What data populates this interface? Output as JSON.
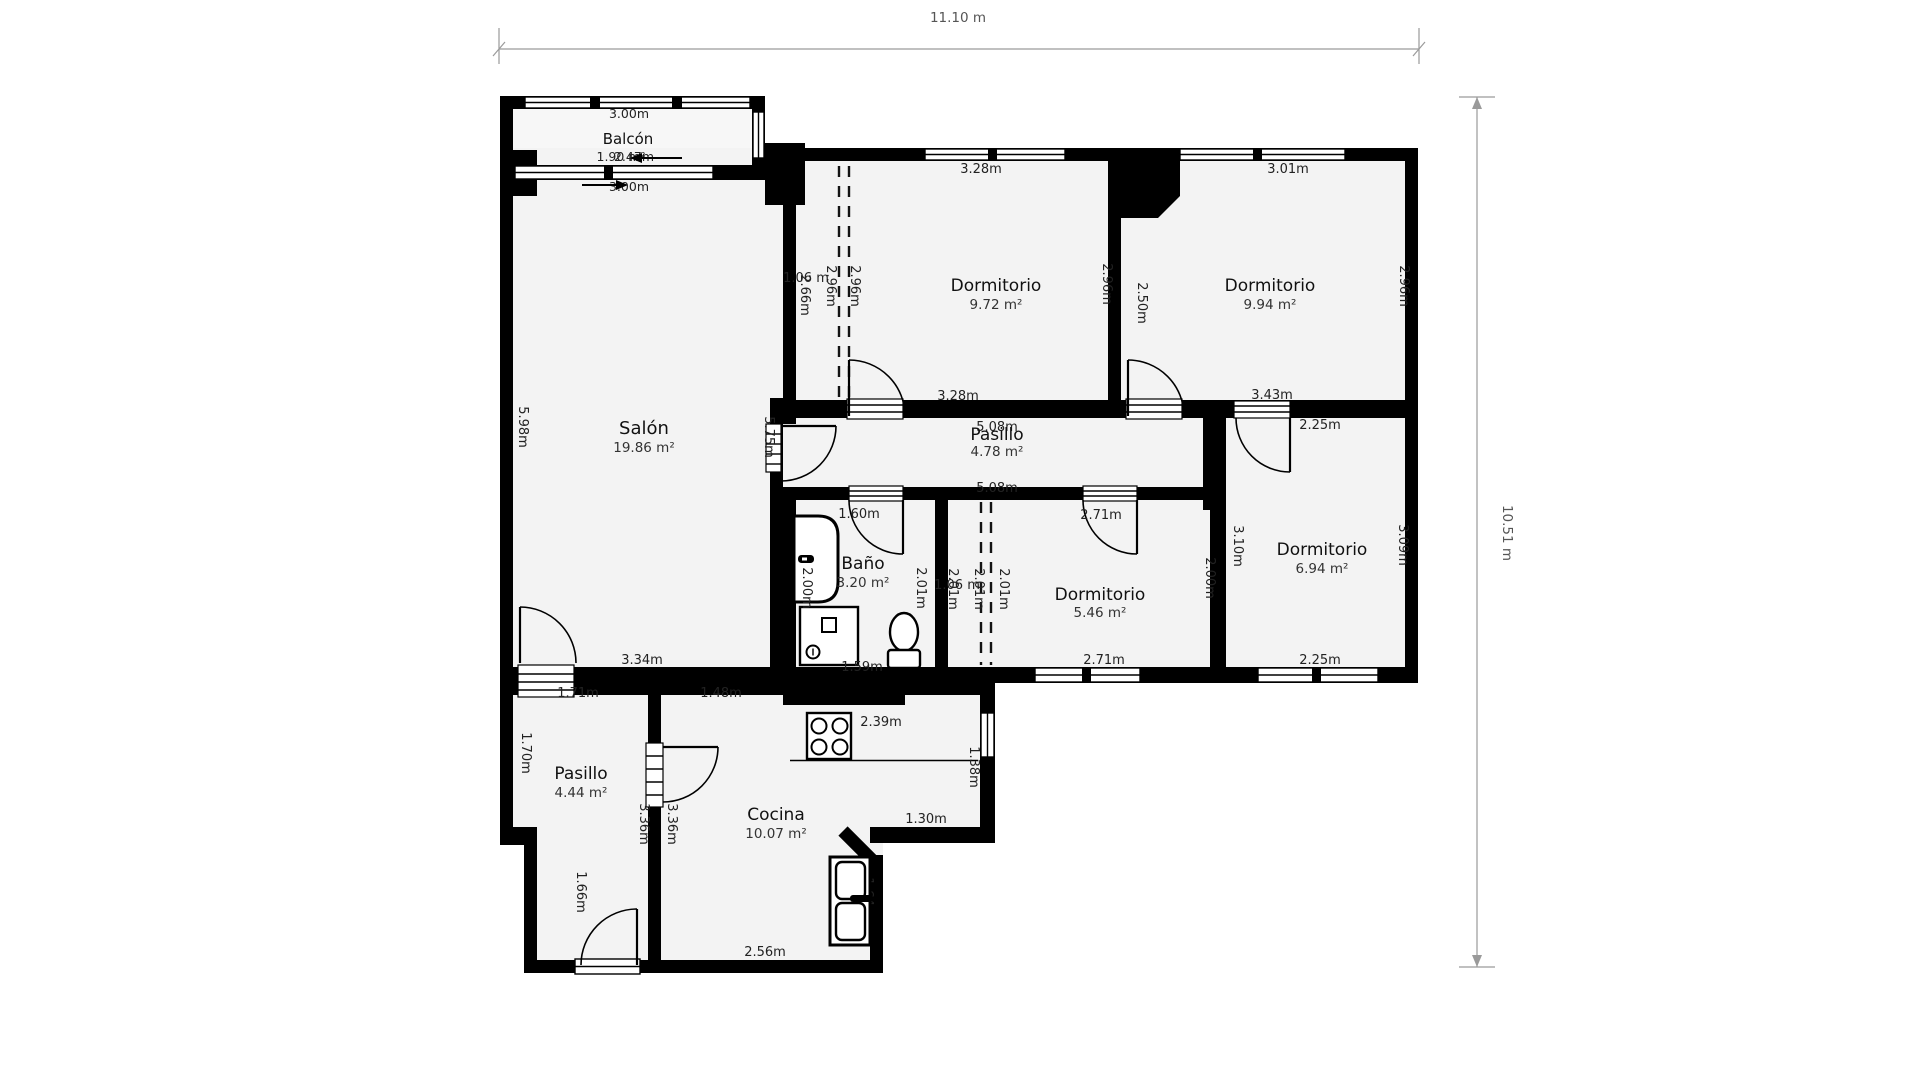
{
  "overall_dims": {
    "width": "11.10 m",
    "height": "10.51 m"
  },
  "balcon": {
    "name": "Balcón",
    "area": "1.90 m²",
    "dim_top": "3.00m",
    "dim_mid": "2.47m",
    "dim_bottom": "3.00m"
  },
  "salon": {
    "name": "Salón",
    "area": "19.86 m²",
    "dim_left": "5.98m",
    "dim_right": "5.75m",
    "dim_bottom": "3.34m"
  },
  "dorm_top_left": {
    "name": "Dormitorio",
    "area": "9.72 m²",
    "dim_top": "3.28m",
    "dim_bottom": "3.28m",
    "dim_right": "2.96m"
  },
  "wardrobe_top": {
    "width": "1.06 m",
    "h1": "2.66m",
    "h2": "2.96m",
    "h3": "2.96m"
  },
  "dorm_top_right": {
    "name": "Dormitorio",
    "area": "9.94 m²",
    "dim_top": "3.01m",
    "dim_left": "2.50m",
    "dim_right": "2.96m",
    "dim_bottom": "3.43m"
  },
  "pasillo": {
    "name": "Pasillo",
    "area": "4.78 m²",
    "dim_top": "5.08m",
    "dim_bottom": "5.08m"
  },
  "bano": {
    "name": "Baño",
    "area": "3.20 m²",
    "door": "1.60m",
    "dim_left": "2.00m",
    "dim_right": "2.01m",
    "dim_fixture": "1.59m"
  },
  "dorm_bottom": {
    "name": "Dormitorio",
    "area": "5.46 m²",
    "dim_top": "2.71m",
    "dim_bottom": "2.71m",
    "dim_right": "2.00m"
  },
  "wardrobe_bottom": {
    "width": "1.06 m",
    "h1": "2.01m",
    "h2": "2.01m",
    "h3": "2.01m"
  },
  "dorm_right": {
    "name": "Dormitorio",
    "area": "6.94 m²",
    "dim_top": "2.25m",
    "dim_left": "3.10m",
    "dim_right": "3.09m",
    "dim_bottom": "2.25m"
  },
  "pasillo2": {
    "name": "Pasillo",
    "area": "4.44 m²",
    "dim_top": "1.71m",
    "dim_left_upper": "1.70m",
    "dim_left_lower": "1.66m",
    "dim_right1": "3.36m",
    "dim_right2": "3.36m"
  },
  "cocina": {
    "name": "Cocina",
    "area": "10.07 m²",
    "dim_top": "1.48m",
    "dim_counter": "2.39m",
    "dim_right": "1.38m",
    "dim_pass": "1.30m",
    "dim_bottom": "2.56m",
    "dim_sink": "1.64m"
  }
}
